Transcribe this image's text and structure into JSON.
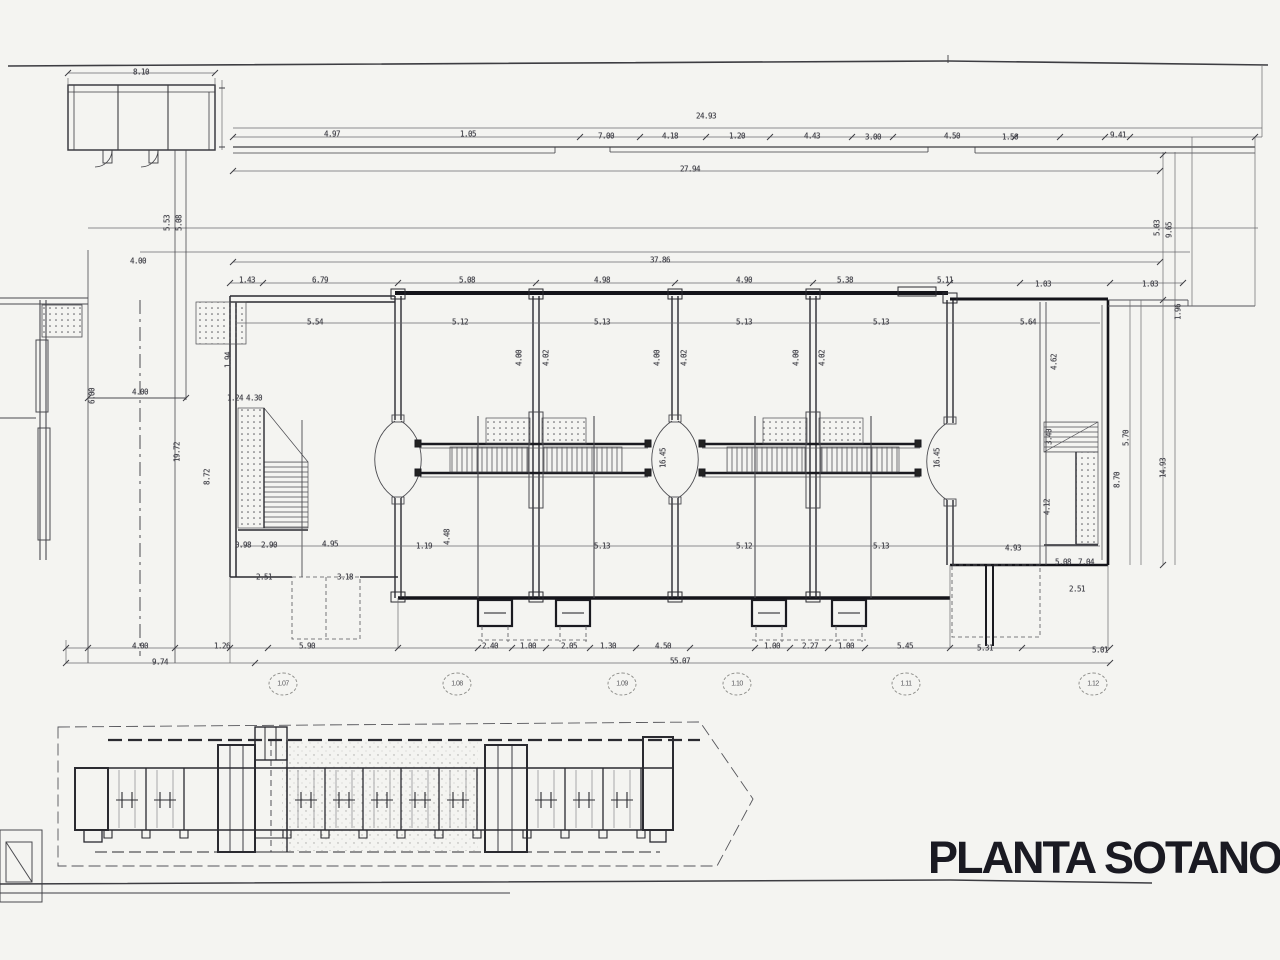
{
  "title": {
    "text": "PLANTA SOTANO",
    "color": "#1a1a22"
  },
  "colors": {
    "paper": "#f4f4f1",
    "ink": "#4a4a4f",
    "wall": "#16161a"
  },
  "axis_markers": [
    {
      "label": "1.07",
      "x": 283,
      "y": 684
    },
    {
      "label": "1.08",
      "x": 457,
      "y": 684
    },
    {
      "label": "1.09",
      "x": 622,
      "y": 684
    },
    {
      "label": "1.10",
      "x": 737,
      "y": 684
    },
    {
      "label": "1.11",
      "x": 906,
      "y": 684
    },
    {
      "label": "1.12",
      "x": 1093,
      "y": 684
    }
  ],
  "dimensions": [
    {
      "t": "8.10",
      "x": 141,
      "y": 72
    },
    {
      "t": "24.93",
      "x": 706,
      "y": 116
    },
    {
      "t": "4.97",
      "x": 332,
      "y": 134
    },
    {
      "t": "1.05",
      "x": 468,
      "y": 134
    },
    {
      "t": "7.00",
      "x": 606,
      "y": 136
    },
    {
      "t": "4.18",
      "x": 670,
      "y": 136
    },
    {
      "t": "1.20",
      "x": 737,
      "y": 136
    },
    {
      "t": "4.43",
      "x": 812,
      "y": 136
    },
    {
      "t": "3.00",
      "x": 873,
      "y": 137
    },
    {
      "t": "4.50",
      "x": 952,
      "y": 136
    },
    {
      "t": "1.50",
      "x": 1010,
      "y": 137
    },
    {
      "t": "9.41",
      "x": 1118,
      "y": 135
    },
    {
      "t": "27.94",
      "x": 690,
      "y": 169
    },
    {
      "t": "37.86",
      "x": 660,
      "y": 260
    },
    {
      "t": "5.53",
      "x": 167,
      "y": 223,
      "r": 1
    },
    {
      "t": "5.08",
      "x": 179,
      "y": 223,
      "r": 1
    },
    {
      "t": "4.00",
      "x": 138,
      "y": 261
    },
    {
      "t": "6.00",
      "x": 92,
      "y": 396,
      "r": 1
    },
    {
      "t": "4.00",
      "x": 140,
      "y": 392
    },
    {
      "t": "19.72",
      "x": 177,
      "y": 452,
      "r": 1
    },
    {
      "t": "8.72",
      "x": 207,
      "y": 477,
      "r": 1
    },
    {
      "t": "1.94",
      "x": 228,
      "y": 360,
      "r": 1
    },
    {
      "t": "1.24",
      "x": 235,
      "y": 398
    },
    {
      "t": "4.30",
      "x": 254,
      "y": 398
    },
    {
      "t": "1.43",
      "x": 247,
      "y": 280
    },
    {
      "t": "6.79",
      "x": 320,
      "y": 280
    },
    {
      "t": "5.08",
      "x": 467,
      "y": 280
    },
    {
      "t": "4.98",
      "x": 602,
      "y": 280
    },
    {
      "t": "4.90",
      "x": 744,
      "y": 280
    },
    {
      "t": "5.38",
      "x": 845,
      "y": 280
    },
    {
      "t": "5.11",
      "x": 945,
      "y": 280
    },
    {
      "t": "1.03",
      "x": 1043,
      "y": 284
    },
    {
      "t": "1.03",
      "x": 1150,
      "y": 284
    },
    {
      "t": "5.54",
      "x": 315,
      "y": 322
    },
    {
      "t": "5.12",
      "x": 460,
      "y": 322
    },
    {
      "t": "5.13",
      "x": 602,
      "y": 322
    },
    {
      "t": "5.13",
      "x": 744,
      "y": 322
    },
    {
      "t": "5.13",
      "x": 881,
      "y": 322
    },
    {
      "t": "5.64",
      "x": 1028,
      "y": 322
    },
    {
      "t": "4.00",
      "x": 519,
      "y": 358,
      "r": 1
    },
    {
      "t": "4.02",
      "x": 546,
      "y": 358,
      "r": 1
    },
    {
      "t": "4.00",
      "x": 657,
      "y": 358,
      "r": 1
    },
    {
      "t": "4.02",
      "x": 684,
      "y": 358,
      "r": 1
    },
    {
      "t": "4.00",
      "x": 796,
      "y": 358,
      "r": 1
    },
    {
      "t": "4.02",
      "x": 822,
      "y": 358,
      "r": 1
    },
    {
      "t": "4.62",
      "x": 1054,
      "y": 362,
      "r": 1
    },
    {
      "t": "16.45",
      "x": 663,
      "y": 458,
      "r": 1
    },
    {
      "t": "16.45",
      "x": 937,
      "y": 458,
      "r": 1
    },
    {
      "t": "5.03",
      "x": 1157,
      "y": 228,
      "r": 1
    },
    {
      "t": "9.65",
      "x": 1169,
      "y": 230,
      "r": 1
    },
    {
      "t": "1.96",
      "x": 1178,
      "y": 312,
      "r": 1
    },
    {
      "t": "5.70",
      "x": 1126,
      "y": 438,
      "r": 1
    },
    {
      "t": "8.70",
      "x": 1117,
      "y": 480,
      "r": 1
    },
    {
      "t": "14.93",
      "x": 1163,
      "y": 468,
      "r": 1
    },
    {
      "t": "3.40",
      "x": 1049,
      "y": 437,
      "r": 1
    },
    {
      "t": "4.12",
      "x": 1047,
      "y": 507,
      "r": 1
    },
    {
      "t": "0.98",
      "x": 243,
      "y": 545
    },
    {
      "t": "2.90",
      "x": 269,
      "y": 545
    },
    {
      "t": "4.95",
      "x": 330,
      "y": 544
    },
    {
      "t": "1.19",
      "x": 424,
      "y": 546
    },
    {
      "t": "4.48",
      "x": 447,
      "y": 537,
      "r": 1
    },
    {
      "t": "5.13",
      "x": 602,
      "y": 546
    },
    {
      "t": "5.12",
      "x": 744,
      "y": 546
    },
    {
      "t": "5.13",
      "x": 881,
      "y": 546
    },
    {
      "t": "4.93",
      "x": 1013,
      "y": 548
    },
    {
      "t": "2.51",
      "x": 264,
      "y": 577
    },
    {
      "t": "3.18",
      "x": 345,
      "y": 577
    },
    {
      "t": "5.08",
      "x": 1063,
      "y": 562
    },
    {
      "t": "7.04",
      "x": 1086,
      "y": 562
    },
    {
      "t": "2.51",
      "x": 1077,
      "y": 589
    },
    {
      "t": "4.00",
      "x": 140,
      "y": 646
    },
    {
      "t": "1.26",
      "x": 222,
      "y": 646
    },
    {
      "t": "5.90",
      "x": 307,
      "y": 646
    },
    {
      "t": "2.40",
      "x": 490,
      "y": 646
    },
    {
      "t": "1.00",
      "x": 528,
      "y": 646
    },
    {
      "t": "2.05",
      "x": 569,
      "y": 646
    },
    {
      "t": "1.30",
      "x": 608,
      "y": 646
    },
    {
      "t": "4.50",
      "x": 663,
      "y": 646
    },
    {
      "t": "1.00",
      "x": 772,
      "y": 646
    },
    {
      "t": "2.27",
      "x": 810,
      "y": 646
    },
    {
      "t": "1.00",
      "x": 846,
      "y": 646
    },
    {
      "t": "5.45",
      "x": 905,
      "y": 646
    },
    {
      "t": "5.31",
      "x": 985,
      "y": 648
    },
    {
      "t": "5.01",
      "x": 1100,
      "y": 650
    },
    {
      "t": "9.74",
      "x": 160,
      "y": 662
    },
    {
      "t": "55.07",
      "x": 680,
      "y": 661
    }
  ]
}
